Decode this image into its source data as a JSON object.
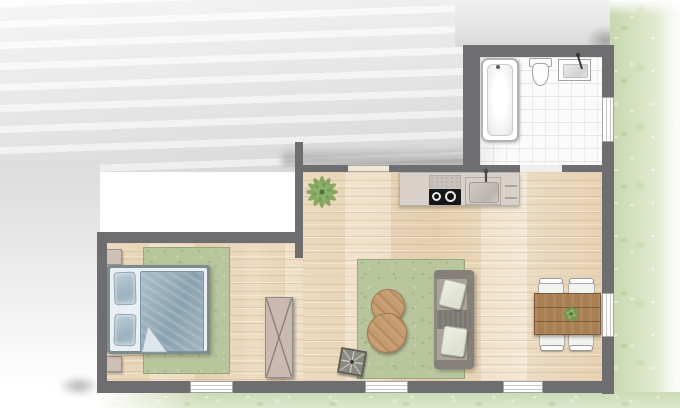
{
  "app": {
    "title": "Apartment floor plan, top-down watercolor rendering",
    "style": "architectural 2D plan with grass border and gray wash exterior"
  },
  "rooms": [
    {
      "name": "bathroom",
      "position": "top-right",
      "floor": "white square tiles",
      "fixtures": [
        "bathtub",
        "toilet",
        "washbasin with faucet",
        "window in right wall",
        "door opening to kitchen"
      ]
    },
    {
      "name": "kitchen-living-room",
      "position": "center-right",
      "floor": "light wood planks",
      "fixtures": [
        "kitchen counter",
        "extractor panel",
        "black cooktop with burners",
        "kitchen sink with faucet",
        "drawer handles",
        "potted floor plant",
        "green area rug",
        "gray sofa with two light cushions and throw",
        "two round wooden coffee tables",
        "patterned pouf",
        "wooden dining table with plant",
        "four white dining chairs",
        "window in right wall",
        "two windows in bottom wall",
        "window opening above kitchen counter"
      ]
    },
    {
      "name": "bedroom",
      "position": "bottom-left",
      "floor": "light wood planks",
      "fixtures": [
        "double bed with two pillows and blue duvet with folded corner",
        "two beige nightstands",
        "green area rug",
        "wardrobe with X front",
        "window in bottom wall",
        "open doorway to living room"
      ]
    }
  ],
  "exterior": {
    "right_edge": "grass strip with white watercolor dabs",
    "bottom_edge": "grass strip fading to white at left",
    "top_left": "gray watercolor wash (outside of unit)"
  },
  "palette": {
    "wall": "#6e6e71",
    "wood_floor": "#ecdcc2",
    "tile": "#fbfbfb",
    "grass": "#d3e0c2",
    "rug": "#b9c59d",
    "duvet": "#93aab6",
    "counter": "#d9d0ca",
    "sofa": "#8f8a84",
    "dining_wood": "#a87e53",
    "coffee_wood": "#c49a6e",
    "wardrobe": "#cbb9af",
    "fixture_white": "#fdfdfd"
  }
}
